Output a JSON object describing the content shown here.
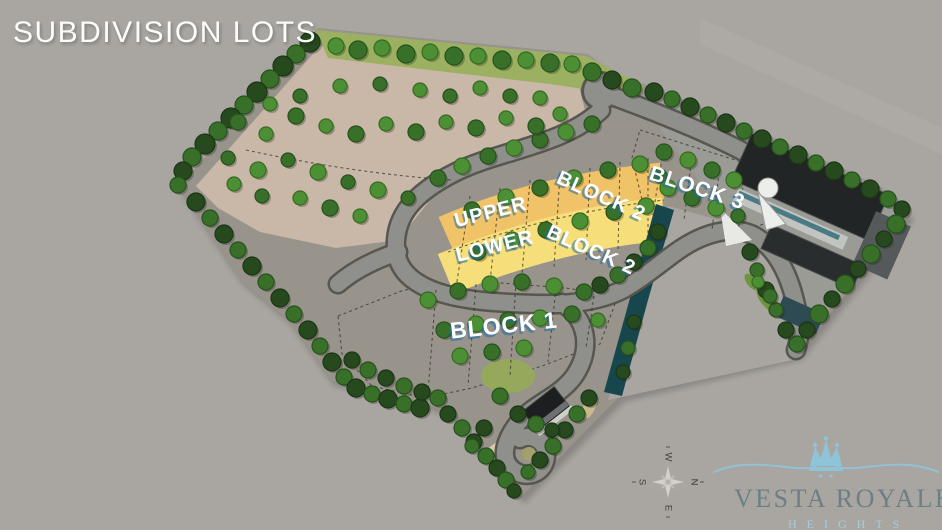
{
  "title": "SUBDIVISION LOTS",
  "map": {
    "labels": {
      "upper": "UPPER",
      "lower": "LOWER",
      "block1": "BLOCK 1",
      "block2_upper": "BLOCK 2",
      "block2_lower": "BLOCK 2",
      "block3": "BLOCK 3"
    },
    "colors": {
      "block1": "#f3ecc0",
      "block2_lower": "#f6df7a",
      "block2_upper": "#f0c368",
      "block3": "#e8a93c",
      "river": "#17474c",
      "open_land": "#c9b7a8",
      "grass": "#9cb061",
      "road": "#8f8f8b",
      "tree_dark": "#26491e",
      "tree_mid": "#38702a",
      "tree_light": "#4c8f34"
    }
  },
  "compass": {
    "north": "N",
    "south": "S",
    "east": "E",
    "west": "W"
  },
  "logo": {
    "name": "VESTA ROYALE",
    "subtitle": "HEIGHTS",
    "crown_color": "#8fc3d8",
    "name_color": "#6d7f86",
    "subtitle_color": "#a6cddc"
  }
}
